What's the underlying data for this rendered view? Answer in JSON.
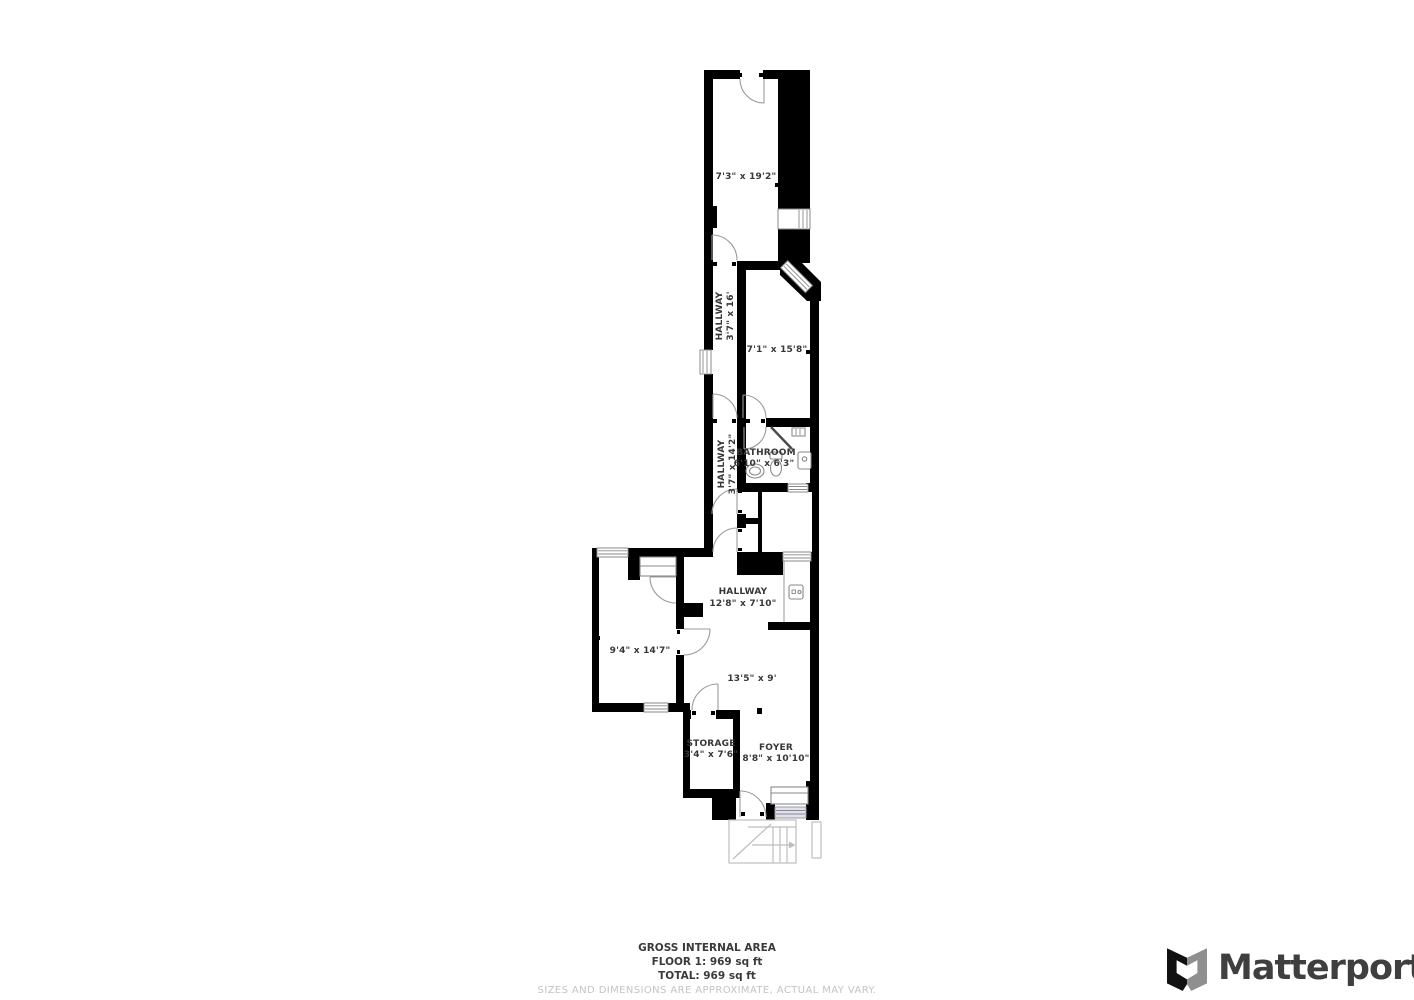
{
  "floorplan": {
    "rooms": [
      {
        "label": "",
        "dims": "7'3\" x 19'2\""
      },
      {
        "label": "HALLWAY",
        "dims": "3'7\" x 16'"
      },
      {
        "label": "",
        "dims": "7'1\" x 15'8\""
      },
      {
        "label": "BATHROOM",
        "dims": "6'10\" x 6'3\""
      },
      {
        "label": "HALLWAY",
        "dims": "3'7\" x 14'2\""
      },
      {
        "label": "HALLWAY",
        "dims": "12'8\" x 7'10\""
      },
      {
        "label": "",
        "dims": "9'4\" x 14'7\""
      },
      {
        "label": "",
        "dims": "13'5\" x 9'"
      },
      {
        "label": "STORAGE",
        "dims": "3'4\" x 7'6\""
      },
      {
        "label": "FOYER",
        "dims": "8'8\" x 10'10\""
      }
    ],
    "footer": {
      "line1": "GROSS INTERNAL AREA",
      "line2": "FLOOR 1: 969 sq ft",
      "line3": "TOTAL: 969 sq ft",
      "disclaimer": "SIZES AND DIMENSIONS ARE APPROXIMATE, ACTUAL MAY VARY."
    }
  },
  "branding": {
    "wordmark": "Matterport",
    "icon": "matterport-m-icon"
  },
  "colors": {
    "wall": "#000000",
    "door_arc": "#9a9a9a",
    "window_frame": "#8a8a8a",
    "stairs": "#bdbdbd",
    "entry_mat": "#e0e0ee",
    "label": "#373737",
    "disclaimer_text": "#c3c3c9",
    "logo_text": "#3f3f3f"
  }
}
